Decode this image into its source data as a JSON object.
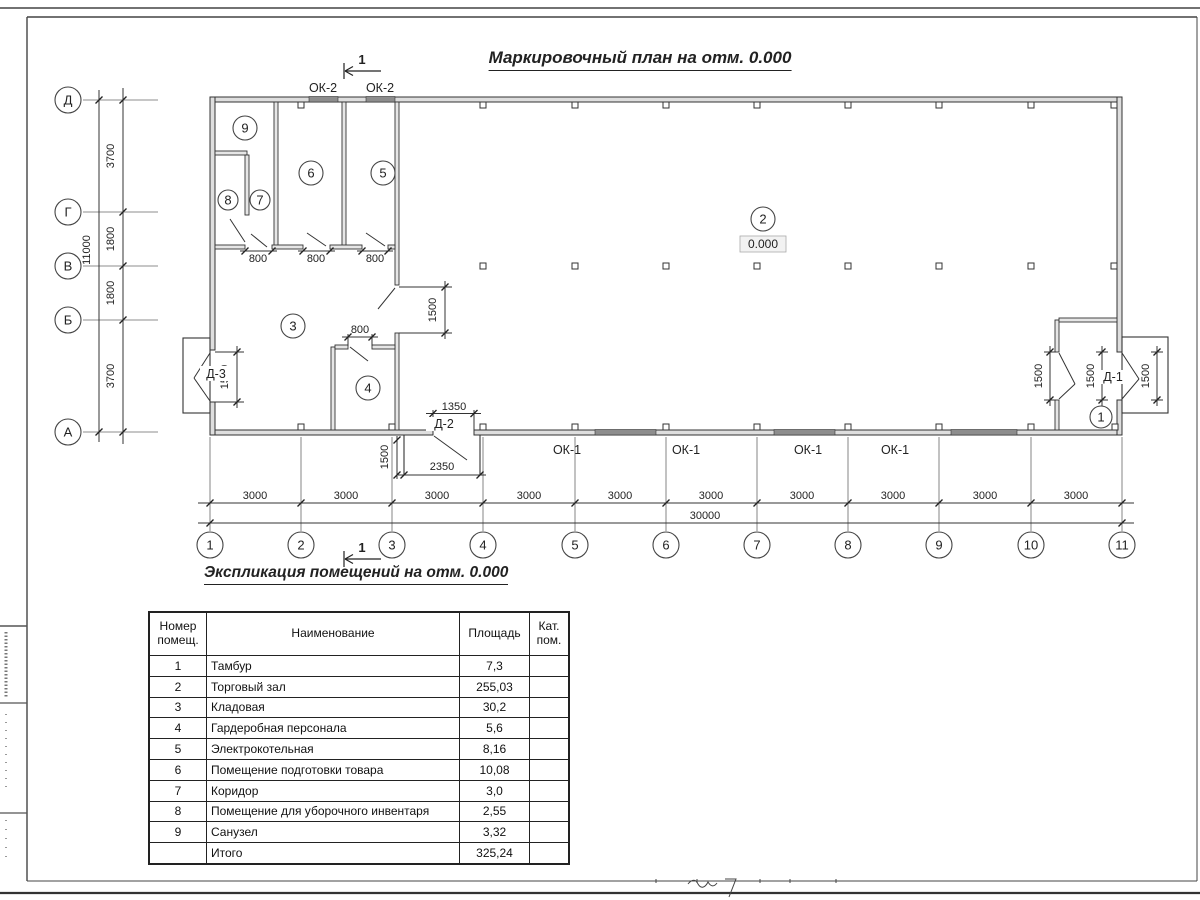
{
  "titles": {
    "plan": "Маркировочный план на отм. 0.000",
    "schedule": "Экспликация помещений на отм. 0.000"
  },
  "plan": {
    "section_label": "1",
    "elevation": "0.000",
    "axes_bottom": [
      "1",
      "2",
      "3",
      "4",
      "5",
      "6",
      "7",
      "8",
      "9",
      "10",
      "11"
    ],
    "axes_left": [
      "Д",
      "Г",
      "В",
      "Б",
      "А"
    ],
    "dims_bottom": [
      "3000",
      "3000",
      "3000",
      "3000",
      "3000",
      "3000",
      "3000",
      "3000",
      "3000",
      "3000"
    ],
    "dim_bottom_total": "30000",
    "dims_left": [
      "3700",
      "1800",
      "1800",
      "3700"
    ],
    "dim_left_total": "11000",
    "windows_top": [
      "ОК-2",
      "ОК-2"
    ],
    "windows_bottom": [
      "ОК-1",
      "ОК-1",
      "ОК-1",
      "ОК-1"
    ],
    "door_d1": "Д-1",
    "door_d2": "Д-2",
    "door_d3": "Д-3",
    "rooms": [
      "1",
      "2",
      "3",
      "4",
      "5",
      "6",
      "7",
      "8",
      "9"
    ],
    "dim_800": "800",
    "dim_1500": "1500",
    "dim_1350": "1350",
    "dim_2350": "2350"
  },
  "schedule": {
    "headers": {
      "num": "Номер помещ.",
      "name": "Наименование",
      "area": "Площадь",
      "cat": "Кат. пом."
    },
    "rows": [
      {
        "num": "1",
        "name": "Тамбур",
        "area": "7,3",
        "cat": ""
      },
      {
        "num": "2",
        "name": "Торговый зал",
        "area": "255,03",
        "cat": ""
      },
      {
        "num": "3",
        "name": "Кладовая",
        "area": "30,2",
        "cat": ""
      },
      {
        "num": "4",
        "name": "Гардеробная персонала",
        "area": "5,6",
        "cat": ""
      },
      {
        "num": "5",
        "name": "Электрокотельная",
        "area": "8,16",
        "cat": ""
      },
      {
        "num": "6",
        "name": "Помещение подготовки товара",
        "area": "10,08",
        "cat": ""
      },
      {
        "num": "7",
        "name": "Коридор",
        "area": "3,0",
        "cat": ""
      },
      {
        "num": "8",
        "name": "Помещение для уборочного инвентаря",
        "area": "2,55",
        "cat": ""
      },
      {
        "num": "9",
        "name": "Санузел",
        "area": "3,32",
        "cat": ""
      },
      {
        "num": "",
        "name": "Итого",
        "area": "325,24",
        "cat": ""
      }
    ]
  }
}
